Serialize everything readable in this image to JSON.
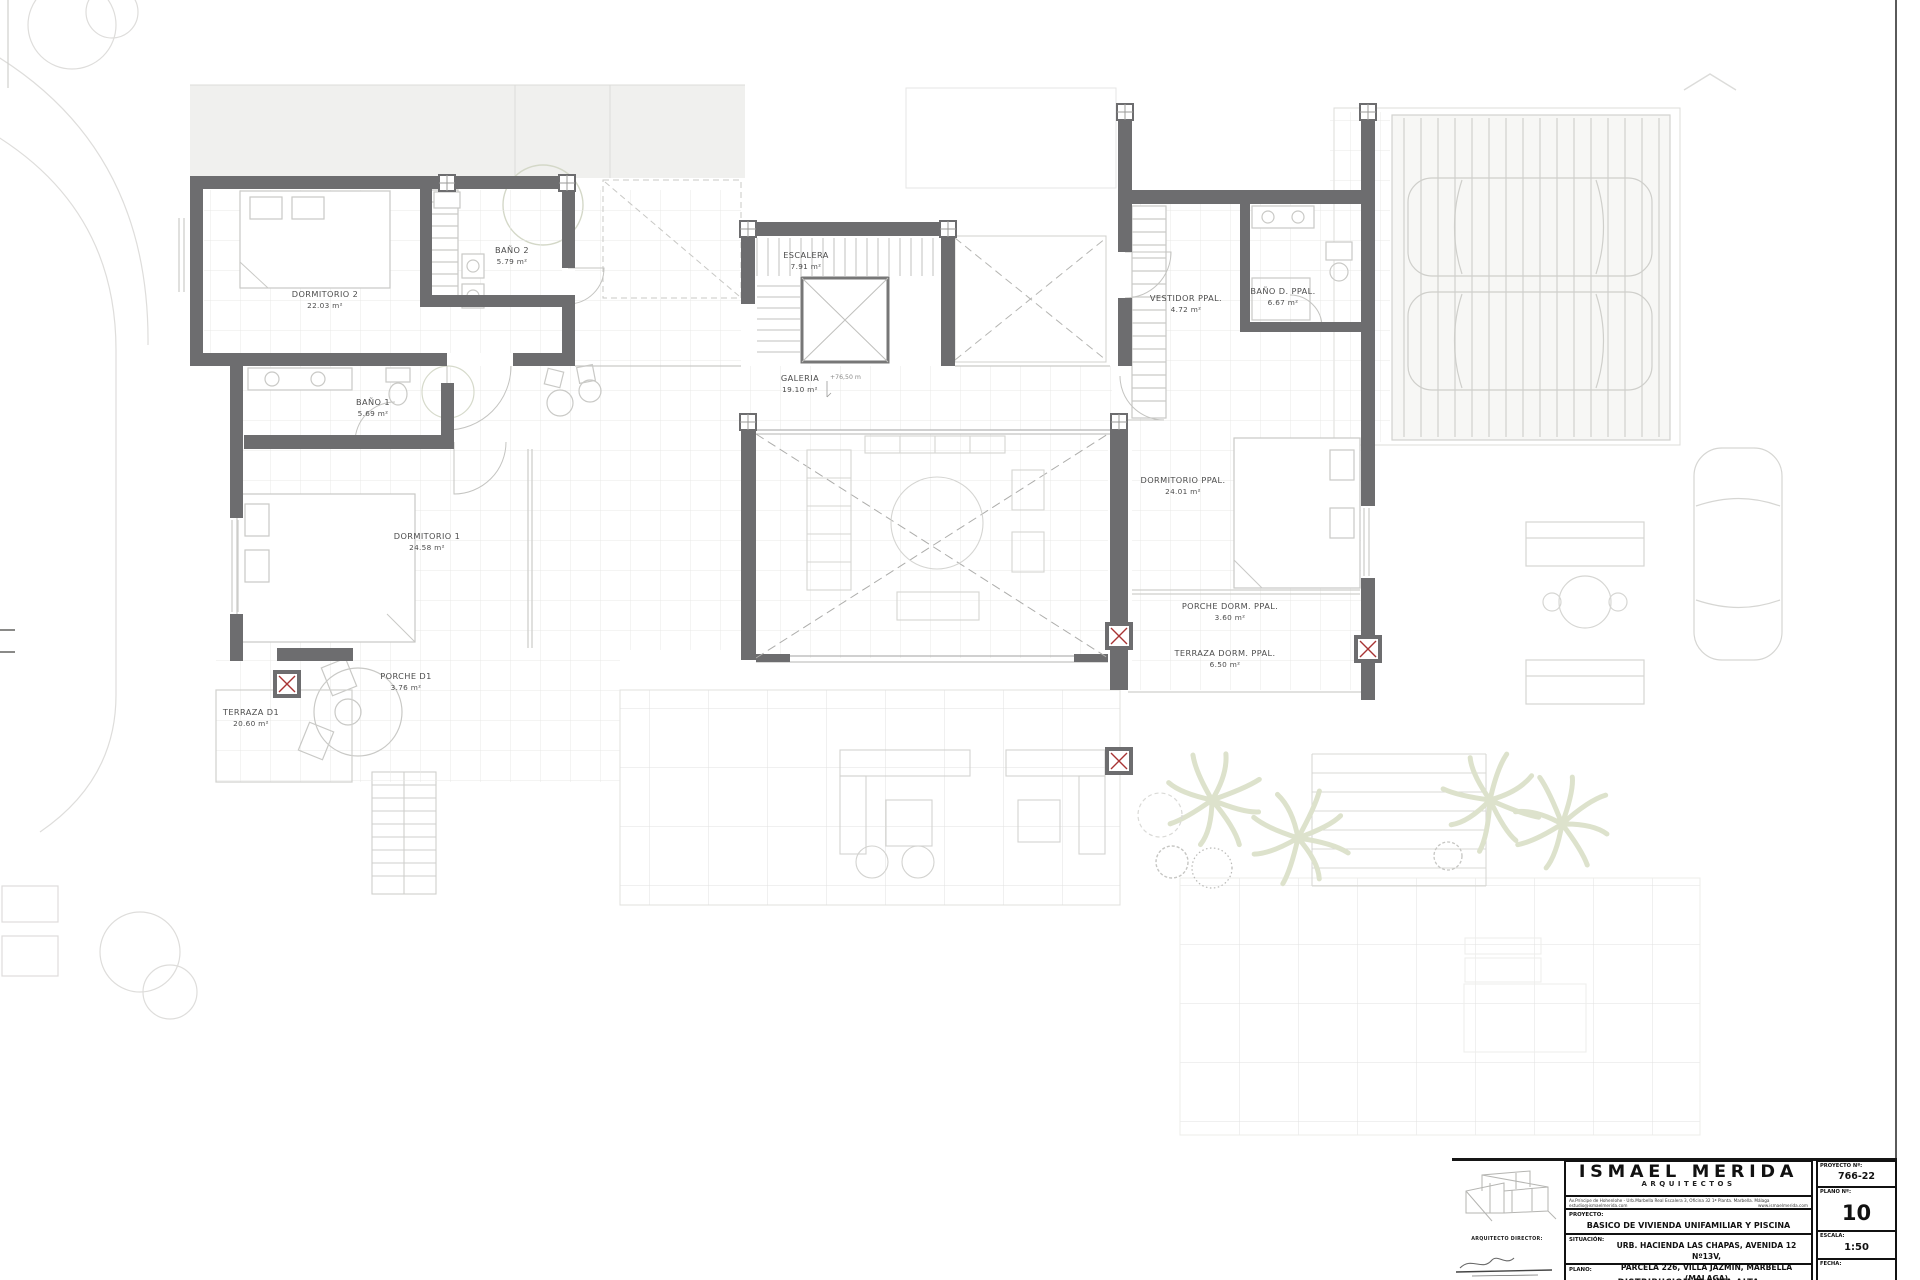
{
  "plan": {
    "rooms": [
      {
        "name": "DORMITORIO 2",
        "area": "22.03 m²"
      },
      {
        "name": "BAÑO 2",
        "area": "5.79 m²"
      },
      {
        "name": "ESCALERA",
        "area": "7.91 m²"
      },
      {
        "name": "VESTIDOR PPAL.",
        "area": "4.72 m²"
      },
      {
        "name": "BAÑO D. PPAL.",
        "area": "6.67 m²"
      },
      {
        "name": "GALERIA",
        "area": "19.10 m²"
      },
      {
        "name": "DORMITORIO PPAL.",
        "area": "24.01 m²"
      },
      {
        "name": "BAÑO 1",
        "area": "5.69 m²"
      },
      {
        "name": "DORMITORIO 1",
        "area": "24.58 m²"
      },
      {
        "name": "PORCHE D1",
        "area": "3.76 m²"
      },
      {
        "name": "TERRAZA D1",
        "area": "20.60 m²"
      },
      {
        "name": "PORCHE DORM. PPAL.",
        "area": "3.60 m²"
      },
      {
        "name": "TERRAZA DORM. PPAL.",
        "area": "6.50 m²"
      }
    ],
    "level_annotation": "+76,50 m"
  },
  "title_block": {
    "firm_name": "ISMAEL MERIDA",
    "firm_subtitle": "ARQUITECTOS",
    "address": "Av.Príncipe de Hohenlohe - Urb.Marbella Real Escalera 3, Oficina 32 1ª Planta. Marbella. Málaga",
    "email": "estudio@ismaelmerida.com",
    "website": "www.ismaelmerida.com",
    "director_label": "ARQUITECTO DIRECTOR:",
    "fields": {
      "proyecto_label": "PROYECTO:",
      "proyecto": "BASICO DE VIVIENDA UNIFAMILIAR Y PISCINA",
      "situacion_label": "SITUACIÓN:",
      "situacion_line1": "URB. HACIENDA LAS CHAPAS, AVENIDA 12 Nº13V,",
      "situacion_line2": "PARCELA 226, VILLA JAZMIN, MARBELLA (MALAGA)",
      "plano_label": "PLANO:",
      "plano": "DISTRIBUCION PLANTA ALTA",
      "proyecto_num_label": "PROYECTO Nº:",
      "proyecto_num": "766-22",
      "plano_num_label": "PLANO Nº:",
      "plano_num": "10",
      "escala_label": "ESCALA:",
      "escala": "1:50",
      "fecha_label": "FECHA:"
    }
  },
  "colors": {
    "wall": "#6d6d6f",
    "column_cross": "#a83434",
    "text": "#4c4c4c"
  }
}
